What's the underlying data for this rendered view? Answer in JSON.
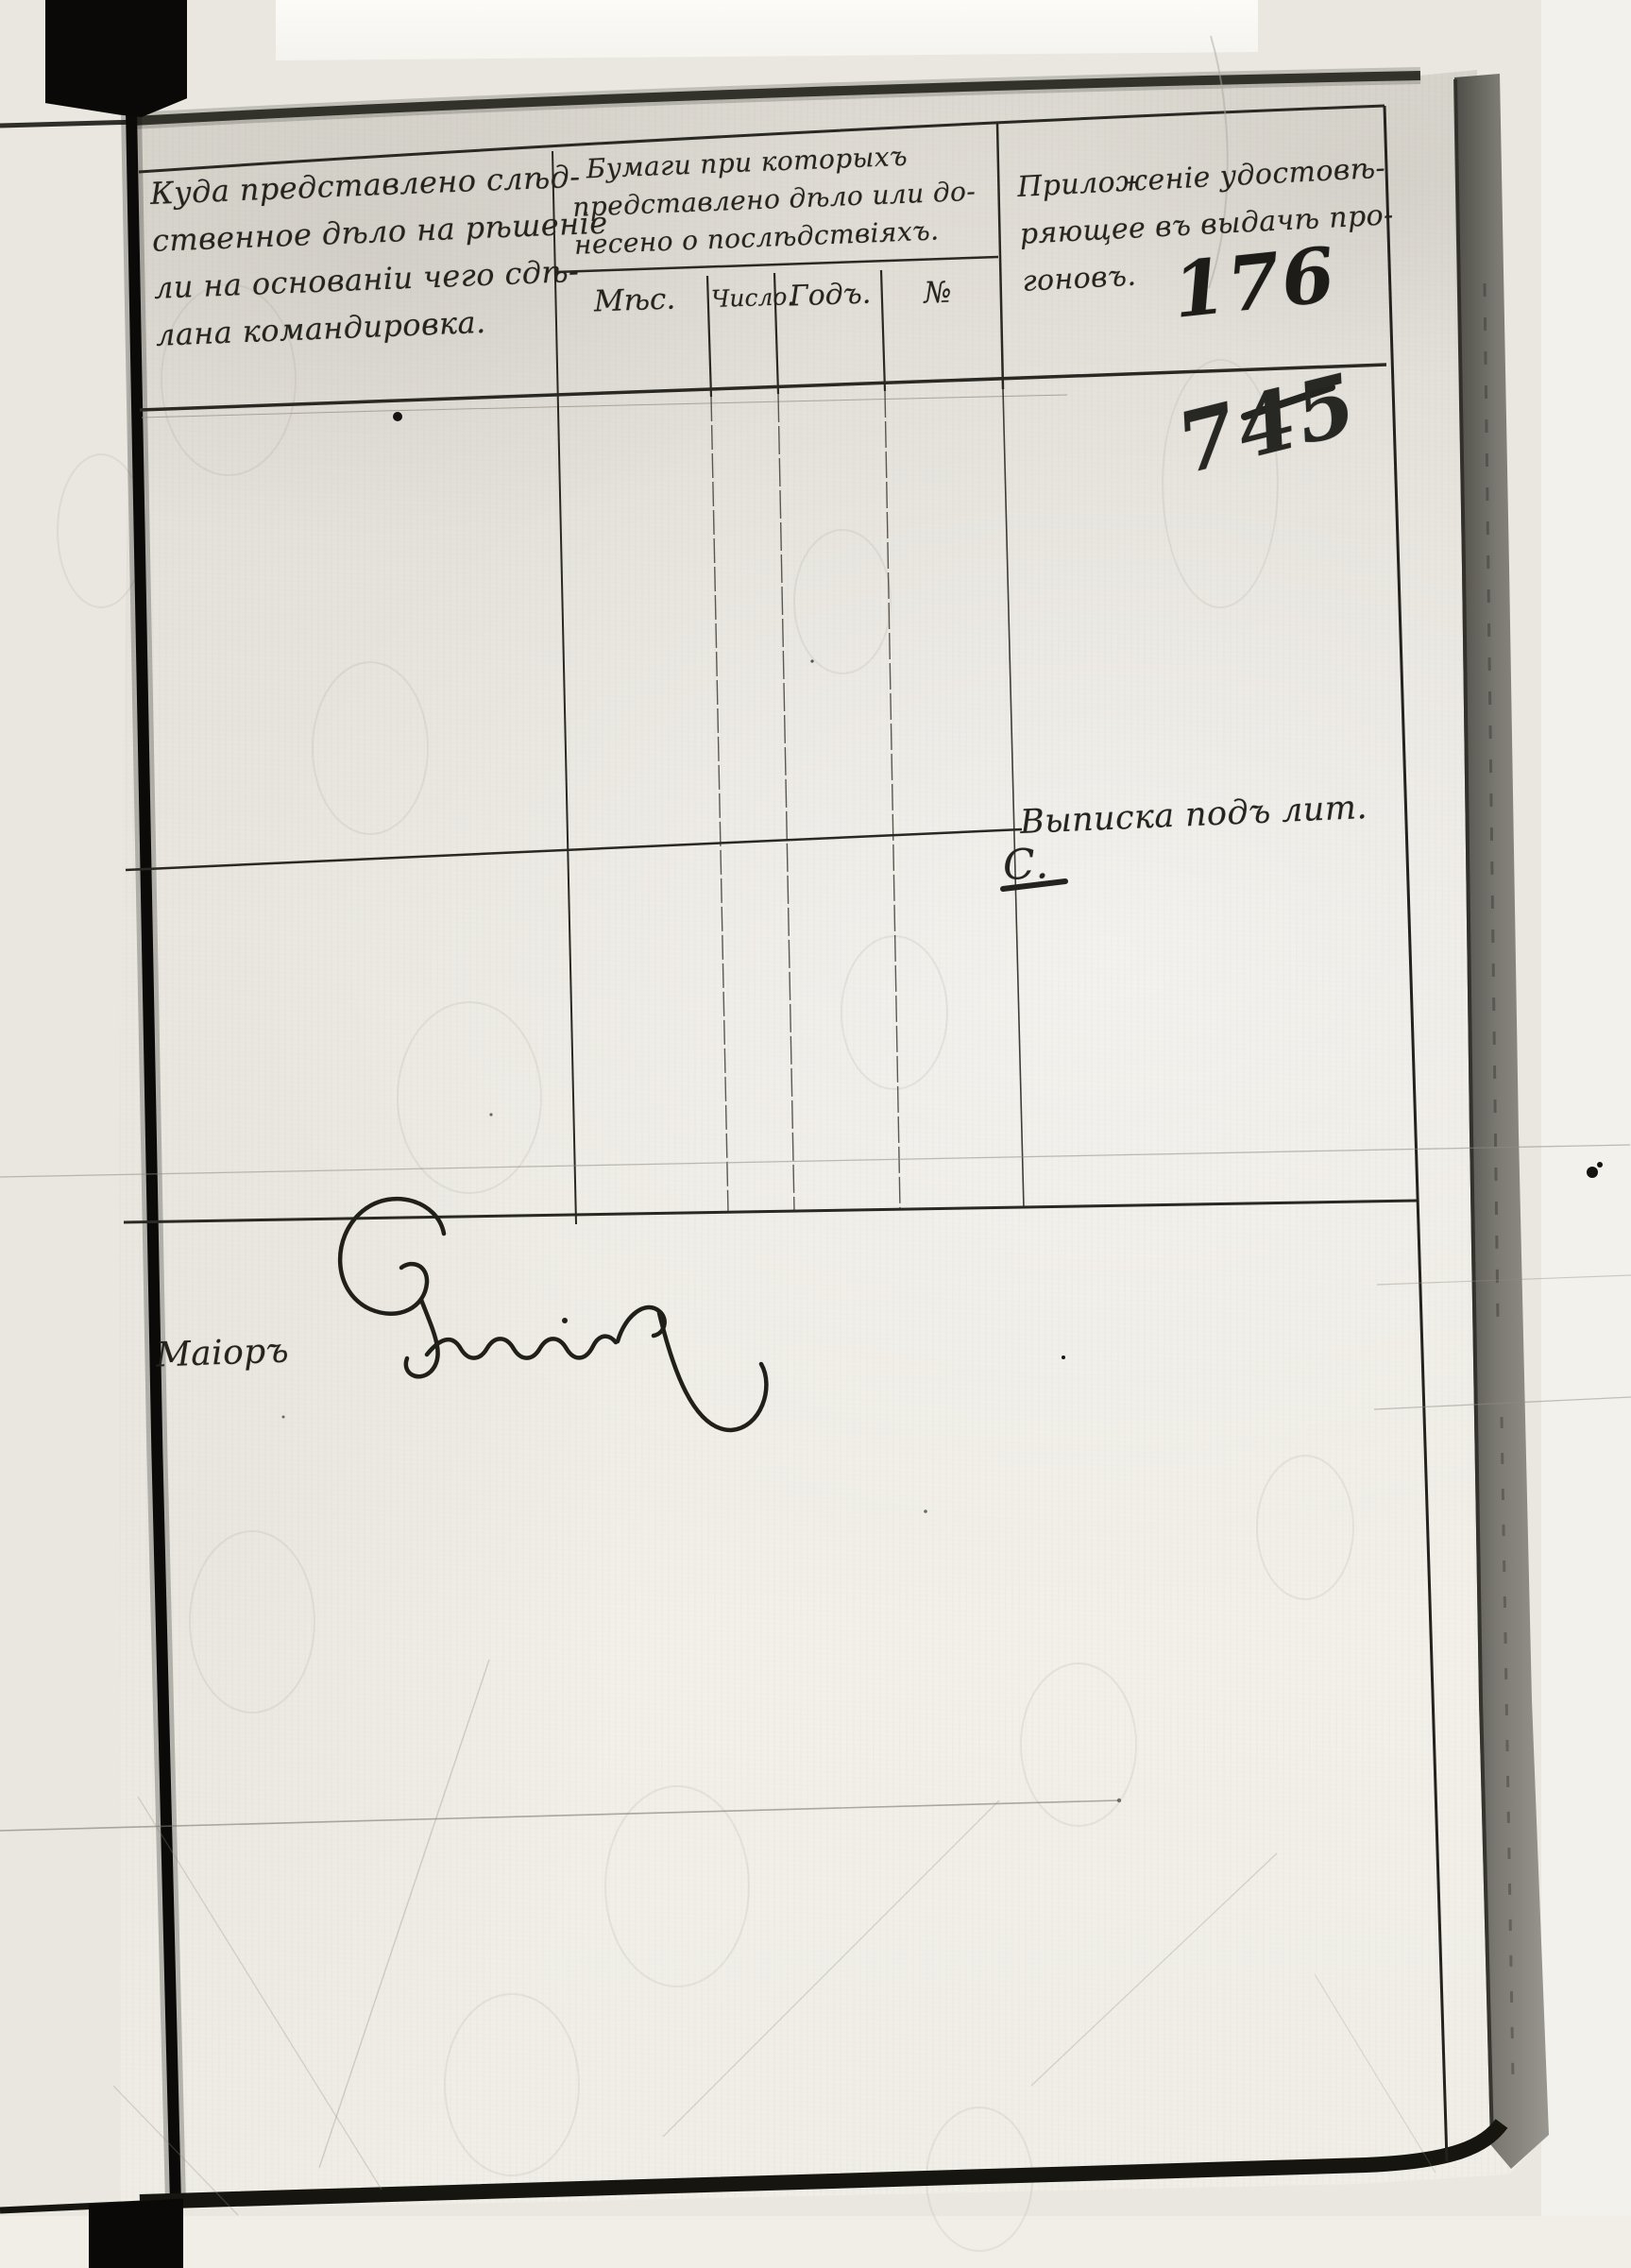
{
  "document_scan": {
    "ink_color": "#25231e",
    "paper_color": "#e4e1da",
    "table": {
      "col_case": {
        "lines": [
          "Куда представлено слѣд-",
          "ственное дѣло на рѣшеніе",
          "ли на основаніи чего сдѣ-",
          "лана командировка."
        ]
      },
      "col_papers": {
        "lines": [
          "Бумаги при которыхъ",
          "представлено дѣло или до-",
          "несено о послѣдствіяхъ."
        ],
        "subcols": [
          "Мѣс.",
          "Число.",
          "Годъ.",
          "№"
        ]
      },
      "col_attachment": {
        "lines": [
          "Приложеніе удостовѣ-",
          "ряющее въ выдачѣ про-",
          "гоновъ."
        ]
      }
    },
    "annotations": {
      "entry_number": "176",
      "page_number": "745",
      "note": "Выписка подъ лит.",
      "note_letter": "С."
    },
    "signature": {
      "rank": "Маіоръ"
    }
  }
}
